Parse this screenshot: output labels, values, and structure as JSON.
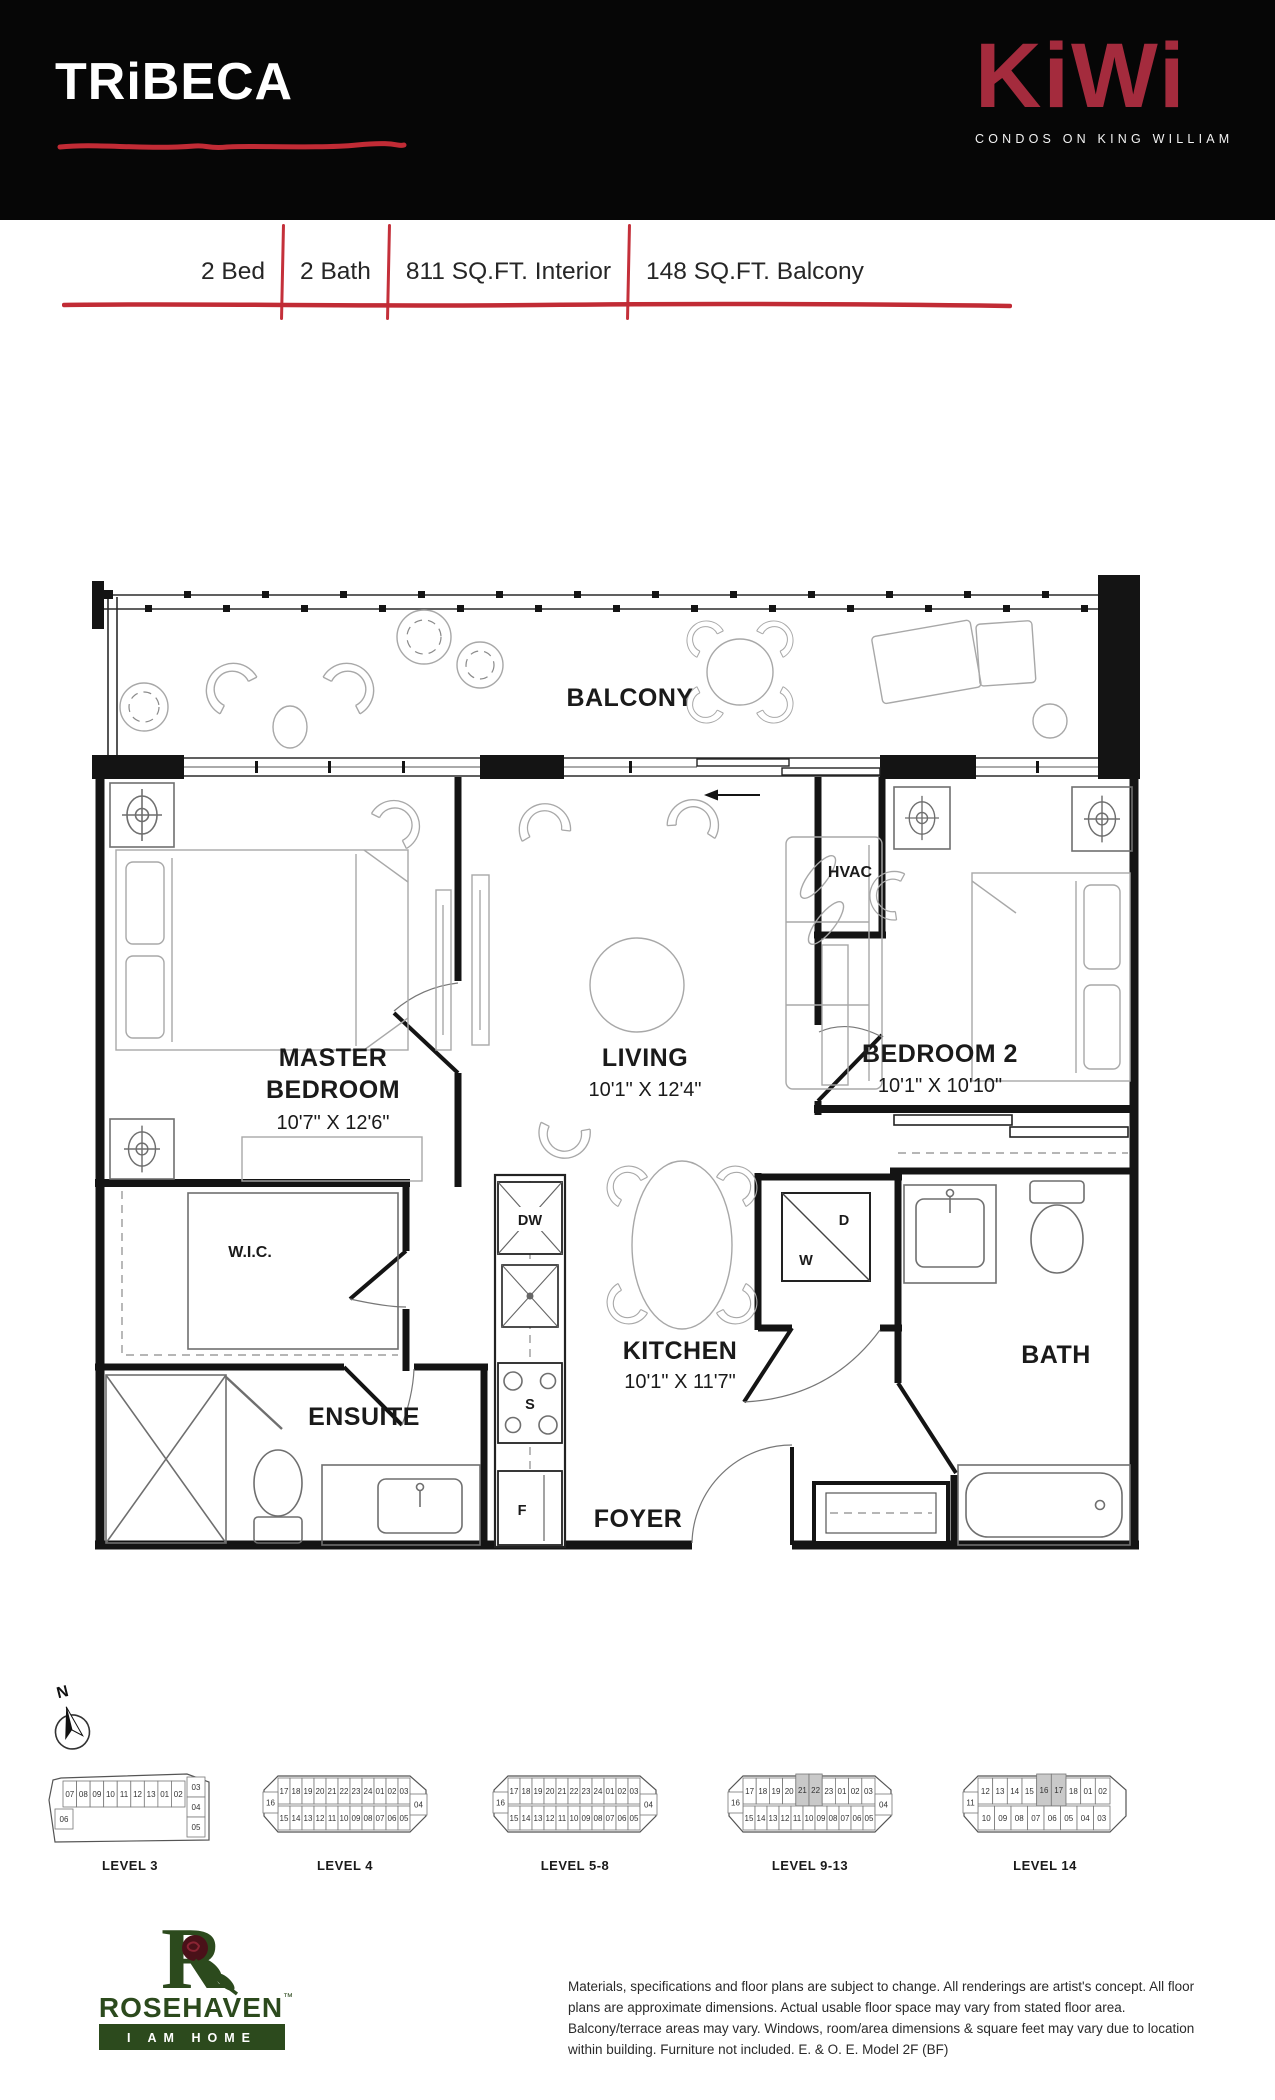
{
  "colors": {
    "header_bg": "#060606",
    "accent_red": "#c4303a",
    "kiwi_red": "#a42b3d",
    "rosehaven_green": "#2c4a1d",
    "wall": "#141414",
    "furniture_gray": "#a8a8a8",
    "highlight_gray": "#c9c9c9"
  },
  "header": {
    "brand": "TRiBECA",
    "logo_name": "KiWi",
    "logo_tagline": "CONDOS ON KING WILLIAM"
  },
  "specs": {
    "items": [
      "2 Bed",
      "2 Bath",
      "811 SQ.FT. Interior",
      "148 SQ.FT. Balcony"
    ]
  },
  "floorplan": {
    "balcony": "BALCONY",
    "hvac": "HVAC",
    "master": {
      "l1": "MASTER",
      "l2": "BEDROOM",
      "dims": "10'7\" X 12'6\""
    },
    "living": {
      "l1": "LIVING",
      "dims": "10'1\" X 12'4\""
    },
    "bedroom2": {
      "l1": "BEDROOM 2",
      "dims": "10'1\" X 10'10\""
    },
    "kitchen": {
      "l1": "KITCHEN",
      "dims": "10'1\" X 11'7\""
    },
    "wic": "W.I.C.",
    "ensuite": "ENSUITE",
    "foyer": "FOYER",
    "bath": "BATH",
    "appliances": {
      "dw": "DW",
      "stove": "S",
      "fridge": "F",
      "dryer": "D",
      "washer": "W"
    }
  },
  "compass": {
    "label": "N"
  },
  "levels": [
    {
      "label": "LEVEL 3",
      "top": [
        "07",
        "08",
        "09",
        "10",
        "11",
        "12",
        "13",
        "01",
        "02"
      ],
      "left": "06",
      "right": [
        "03",
        "04",
        "05"
      ],
      "bottom": [],
      "highlight": []
    },
    {
      "label": "LEVEL 4",
      "top": [
        "17",
        "18",
        "19",
        "20",
        "21",
        "22",
        "23",
        "24",
        "01",
        "02",
        "03"
      ],
      "left": "16",
      "right": [
        "04"
      ],
      "bottom": [
        "15",
        "14",
        "13",
        "12",
        "11",
        "10",
        "09",
        "08",
        "07",
        "06",
        "05"
      ],
      "highlight": []
    },
    {
      "label": "LEVEL 5-8",
      "top": [
        "17",
        "18",
        "19",
        "20",
        "21",
        "22",
        "23",
        "24",
        "01",
        "02",
        "03"
      ],
      "left": "16",
      "right": [
        "04"
      ],
      "bottom": [
        "15",
        "14",
        "13",
        "12",
        "11",
        "10",
        "09",
        "08",
        "07",
        "06",
        "05"
      ],
      "highlight": []
    },
    {
      "label": "LEVEL 9-13",
      "top": [
        "17",
        "18",
        "19",
        "20",
        "21",
        "22",
        "23",
        "01",
        "02",
        "03"
      ],
      "left": "16",
      "right": [
        "04"
      ],
      "bottom": [
        "15",
        "14",
        "13",
        "12",
        "11",
        "10",
        "09",
        "08",
        "07",
        "06",
        "05"
      ],
      "highlight": [
        "21",
        "22"
      ]
    },
    {
      "label": "LEVEL 14",
      "top": [
        "12",
        "13",
        "14",
        "15",
        "16",
        "17",
        "18",
        "01",
        "02"
      ],
      "left": "11",
      "right": [],
      "bottom": [
        "10",
        "09",
        "08",
        "07",
        "06",
        "05",
        "04",
        "03"
      ],
      "highlight": [
        "16",
        "17"
      ]
    }
  ],
  "builder": {
    "name": "ROSEHAVEN",
    "trademark": "™",
    "tagline": "I AM HOME"
  },
  "disclaimer": "Materials, specifications and floor plans are subject to change. All renderings are artist's concept. All floor plans are approximate dimensions. Actual usable floor space may vary from stated floor area. Balcony/terrace areas may vary. Windows, room/area dimensions & square feet may vary due to location within building. Furniture not included. E. & O. E. Model 2F (BF)"
}
